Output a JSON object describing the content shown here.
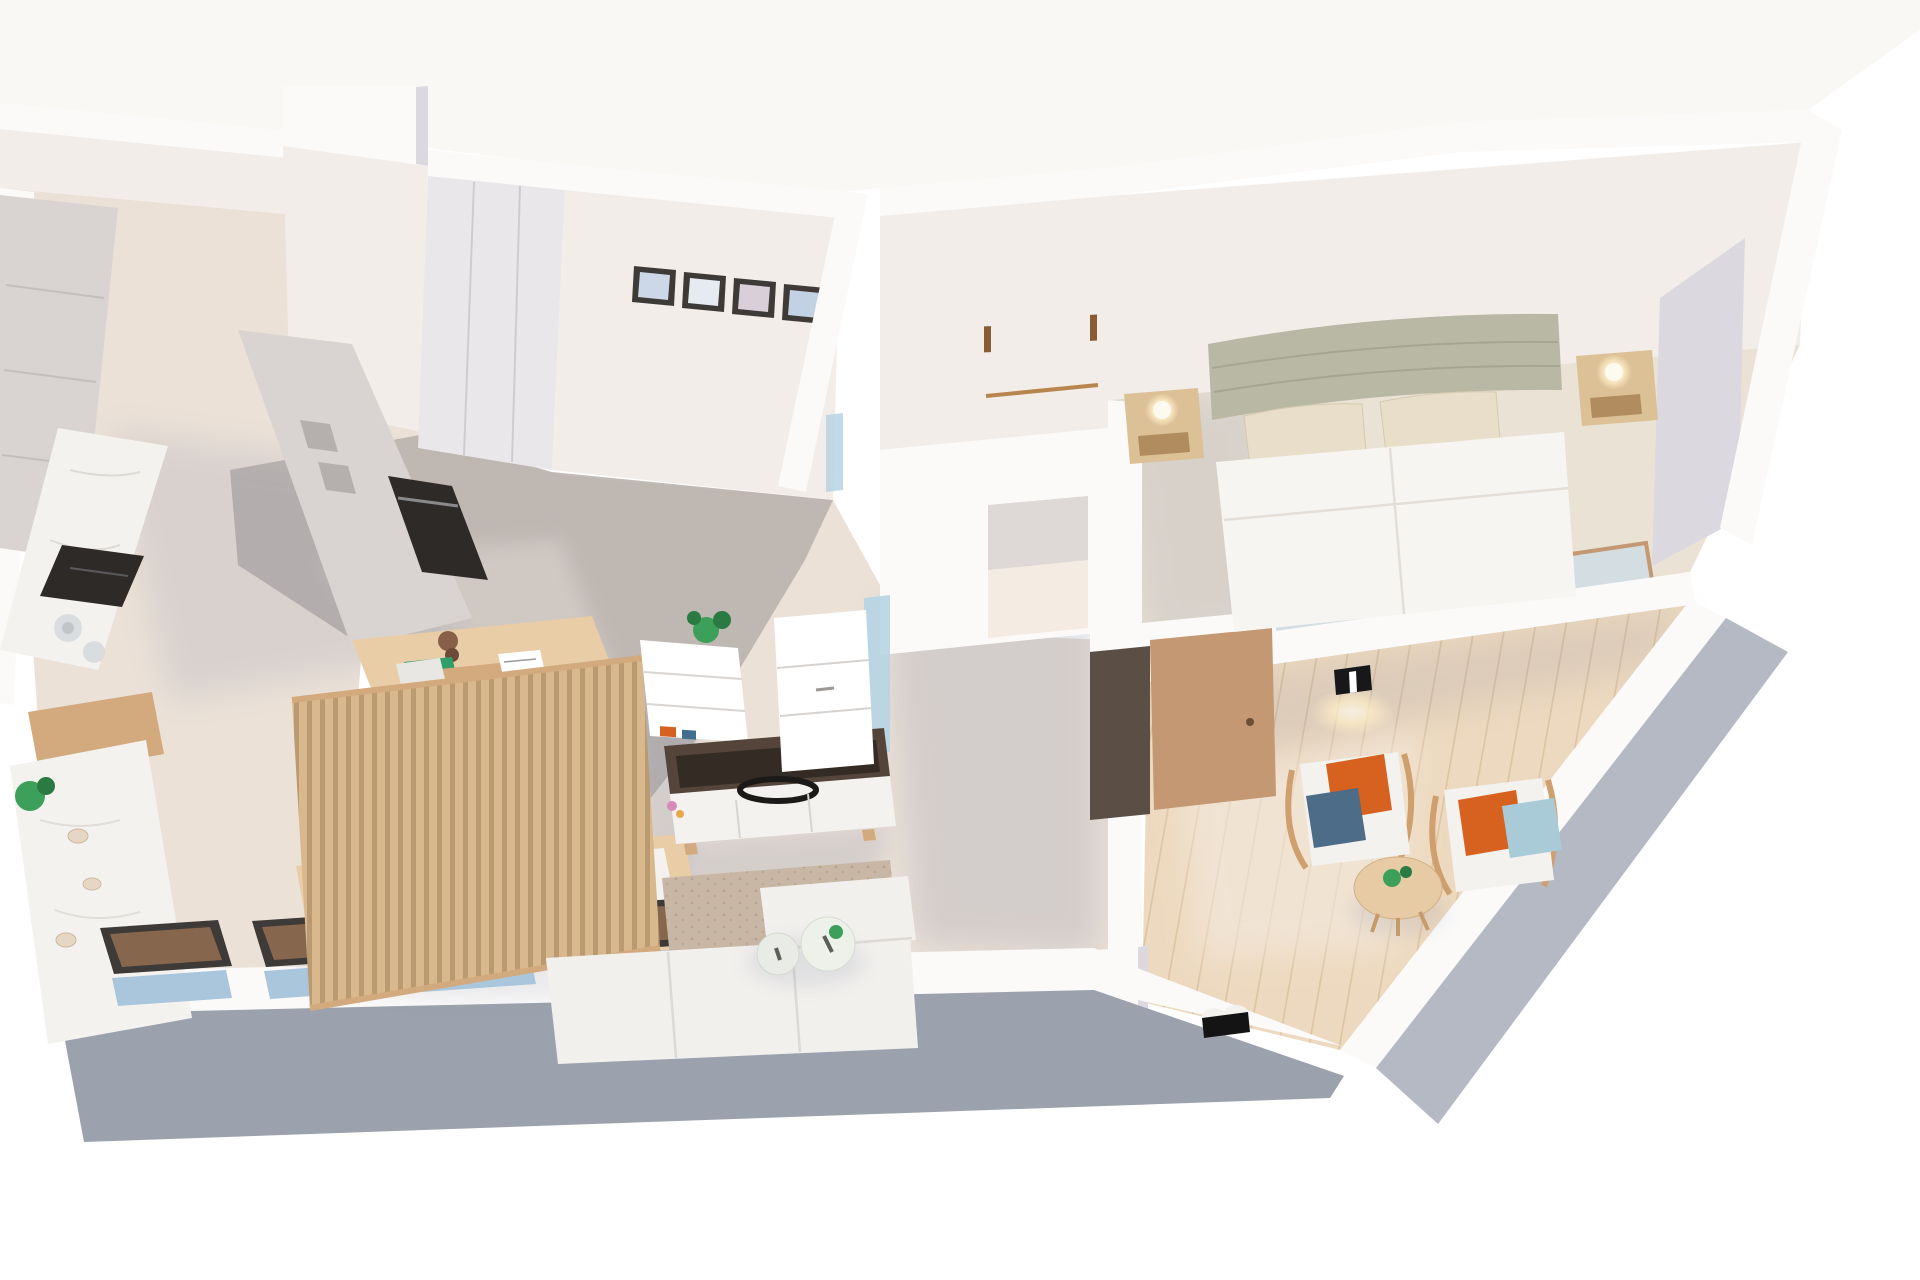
{
  "scene": {
    "type": "3d-floor-plan-render",
    "description": "isometric cutaway render of a one-bedroom apartment, no visible text",
    "rooms": [
      {
        "name": "kitchen",
        "furniture": [
          "tall-cabinet-column",
          "marble-counter",
          "induction-hob",
          "glass-kettle",
          "oven-column",
          "built-in-oven",
          "open-shelves",
          "island-counter",
          "potted-plant",
          "decor-shells"
        ]
      },
      {
        "name": "dining-area",
        "furniture": [
          "marble-dining-table",
          "wood-chair",
          "wood-chair",
          "decor-bowl",
          "decor-bowl",
          "decor-bowl",
          "decor-bowl"
        ],
        "window_count": 4
      },
      {
        "name": "home-office",
        "furniture": [
          "sliding-wardrobe",
          "picture-frame",
          "picture-frame",
          "picture-frame",
          "picture-frame",
          "wood-desk",
          "desk-lamp",
          "notebook",
          "office-chair",
          "wood-slat-partition"
        ],
        "frame_count": 4
      },
      {
        "name": "living-room",
        "furniture": [
          "white-shelf-unit",
          "monstera-plant",
          "tv-cabinet",
          "tv",
          "modular-sofa",
          "area-rug",
          "round-coffee-table",
          "round-coffee-table"
        ]
      },
      {
        "name": "bathroom",
        "furniture": [
          "towel-rail",
          "shower-glass",
          "frosted-glass-door",
          "door-opening"
        ]
      },
      {
        "name": "hallway",
        "furniture": [
          "entry-door-open",
          "drawer-cabinet",
          "wall-column"
        ]
      },
      {
        "name": "bedroom",
        "furniture": [
          "double-bed",
          "upholstered-headboard",
          "pillow",
          "pillow",
          "floating-nightstand",
          "floating-nightstand",
          "sphere-lamp",
          "sphere-lamp",
          "gray-wardrobe",
          "sliding-glass-door"
        ]
      },
      {
        "name": "terrace",
        "furniture": [
          "wood-armchair",
          "wood-armchair",
          "throw-pillows",
          "round-side-table",
          "small-plant",
          "wall-sconce",
          "slippers"
        ]
      }
    ],
    "view": "top-down axonometric, apartment rotated slightly, diagonal facade cut at lower right"
  },
  "palette": {
    "wallTop": "#fbfaf9",
    "wallFace": "#f3ede9",
    "wallFaceCool": "#e9e7ea",
    "wallShade": "#dbd9df",
    "outerGray": "#9ba1ad",
    "outerGrayLight": "#b4b9c3",
    "floorMain": "#ebe1d7",
    "floorLight": "#f4ece3",
    "floorGray": "#b7afac",
    "floorGrayLight": "#d0c8c3",
    "floorWood": "#edd9bf",
    "plankLine": "#dcc3a2",
    "carpet": "#eae2d4",
    "rug": "#c9b7a5",
    "rugDot": "#b29e8a",
    "marble": "#f4f2ef",
    "marbleVein": "#d8d4d0",
    "cabinet": "#d9d4d1",
    "cabinetDark": "#c8c3c0",
    "woodLight": "#e8cda6",
    "woodMid": "#d3aa7d",
    "slat": "#d8b88c",
    "slatGap": "#ba9b71",
    "dark": "#2e2a27",
    "tvTray": "#54443a",
    "tvDark": "#342b25",
    "sofa": "#f2f0ed",
    "bedWhite": "#f7f5f2",
    "headboard": "#b9b8a5",
    "pillowBeige": "#e8dec9",
    "nightstand": "#dcc096",
    "lampGlow": "#ffefca",
    "doorTan": "#c39873",
    "nicheDark": "#5a4e45",
    "glassBlue": "#b7d4e3",
    "windowPane": "#86674e",
    "windowBlue": "#a9c6dc",
    "frameDark": "#3d3a37",
    "plantGreen": "#3da05a",
    "plantDark": "#2a7a42",
    "pillowOrange": "#d7611f",
    "pillowBlue": "#4d6c87",
    "pillowSky": "#a9cbd8",
    "shadow": "#78809c",
    "ground": "#f6f2ec"
  }
}
